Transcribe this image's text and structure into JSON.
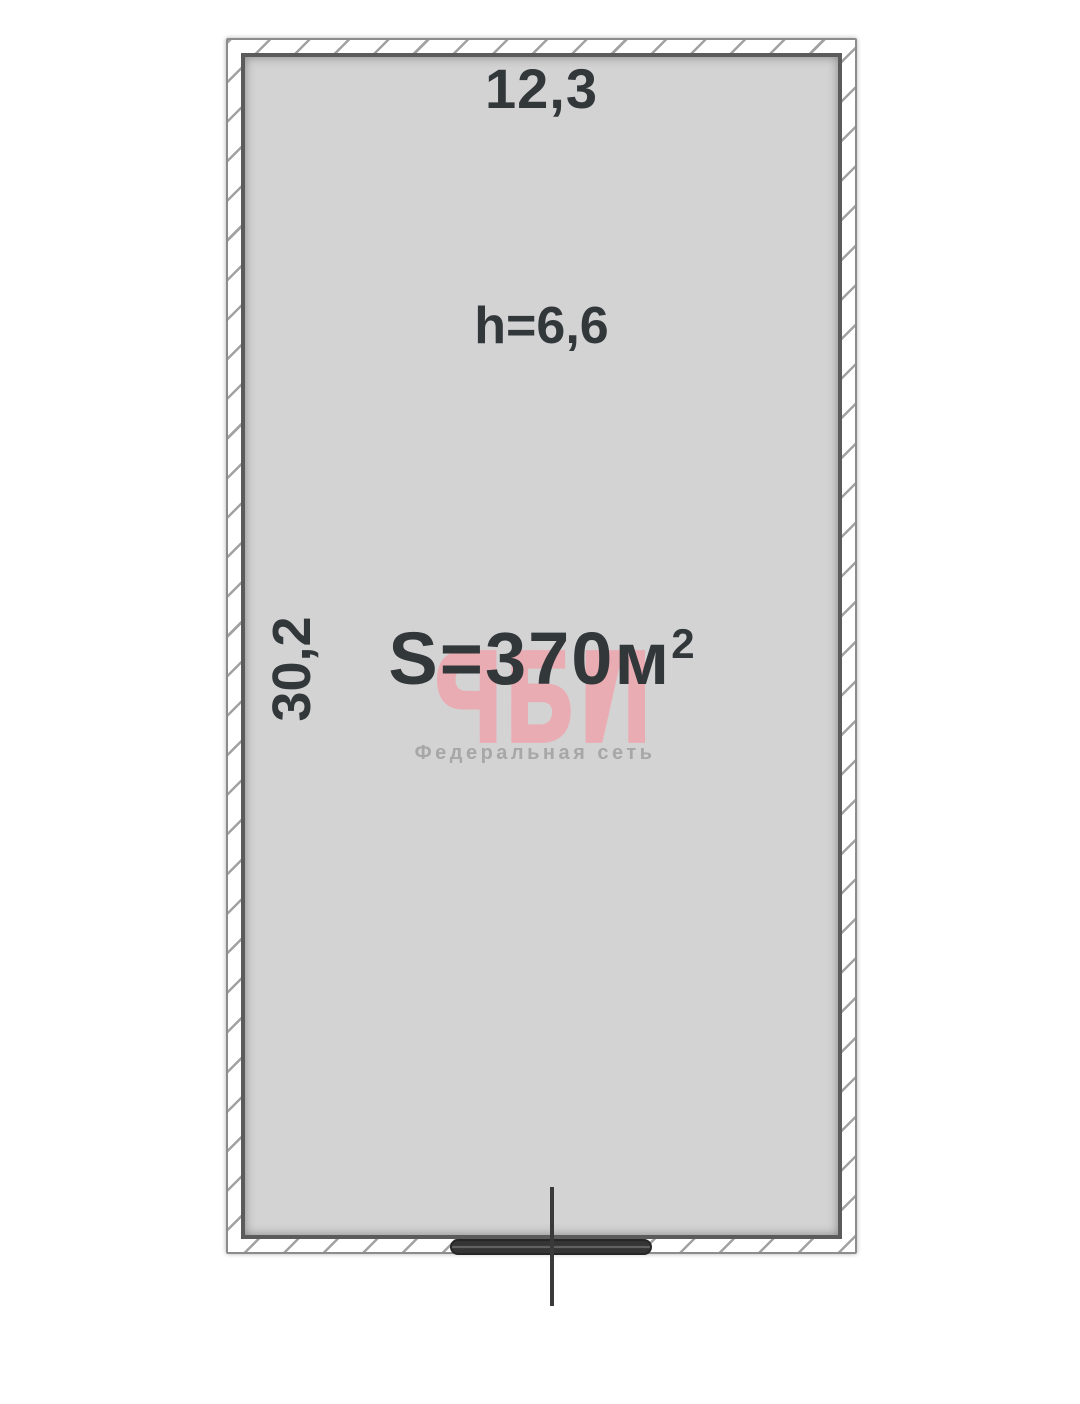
{
  "floor_plan": {
    "dimensions": {
      "width": "12,3",
      "depth": "30,2"
    },
    "ceiling_height": "h=6,6",
    "area": {
      "base": "S=370м",
      "superscript": "2",
      "full": "S=370м²"
    },
    "watermark": {
      "logo": "РБН",
      "subtitle": "Федеральная сеть"
    },
    "colors": {
      "interior_fill": "#d3d3d3",
      "wall_fill": "#ffffff",
      "wall_hatch": "#a2a2a2",
      "wall_outline": "#5b5b5b",
      "label_text": "#32373a",
      "watermark_pink": "#eca9b1",
      "watermark_gray": "#a7a7a7",
      "entrance_gate": "#343434"
    }
  }
}
